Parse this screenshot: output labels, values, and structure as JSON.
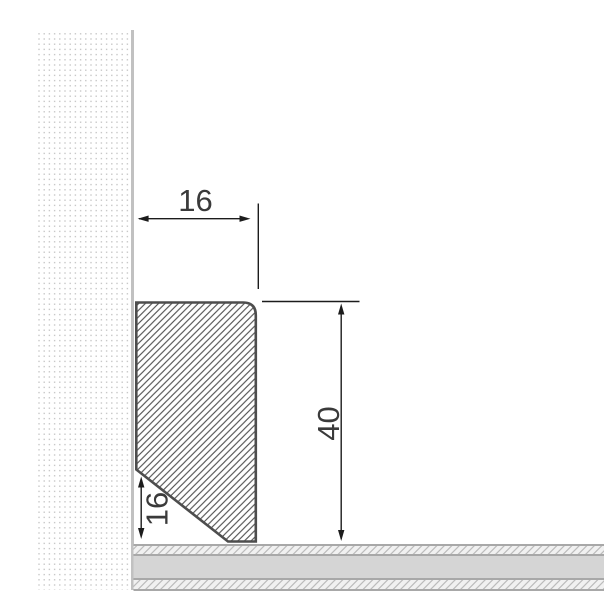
{
  "drawing": {
    "type": "cross-section technical drawing",
    "subject": "skirting profile mounted at wall and floor junction",
    "dim_top_width": {
      "value": "16",
      "orientation": "horizontal"
    },
    "dim_height": {
      "value": "40",
      "orientation": "vertical"
    },
    "dim_chamfer_height": {
      "value": "16",
      "orientation": "vertical"
    },
    "colors": {
      "background": "#ffffff",
      "profile_outline": "#4d4d4d",
      "profile_hatch": "#525252",
      "wall_dot": "#c7c7c7",
      "wall_edge": "#c1c1c1",
      "floor_border": "#a8a8a8",
      "floor_core": "#d5d5d5",
      "floor_hatch": "#bcbcbc",
      "floor_hatch_bg": "#f1f1f1",
      "dimension_line": "#1c1c1c",
      "dimension_text": "#3a3a3a"
    }
  }
}
